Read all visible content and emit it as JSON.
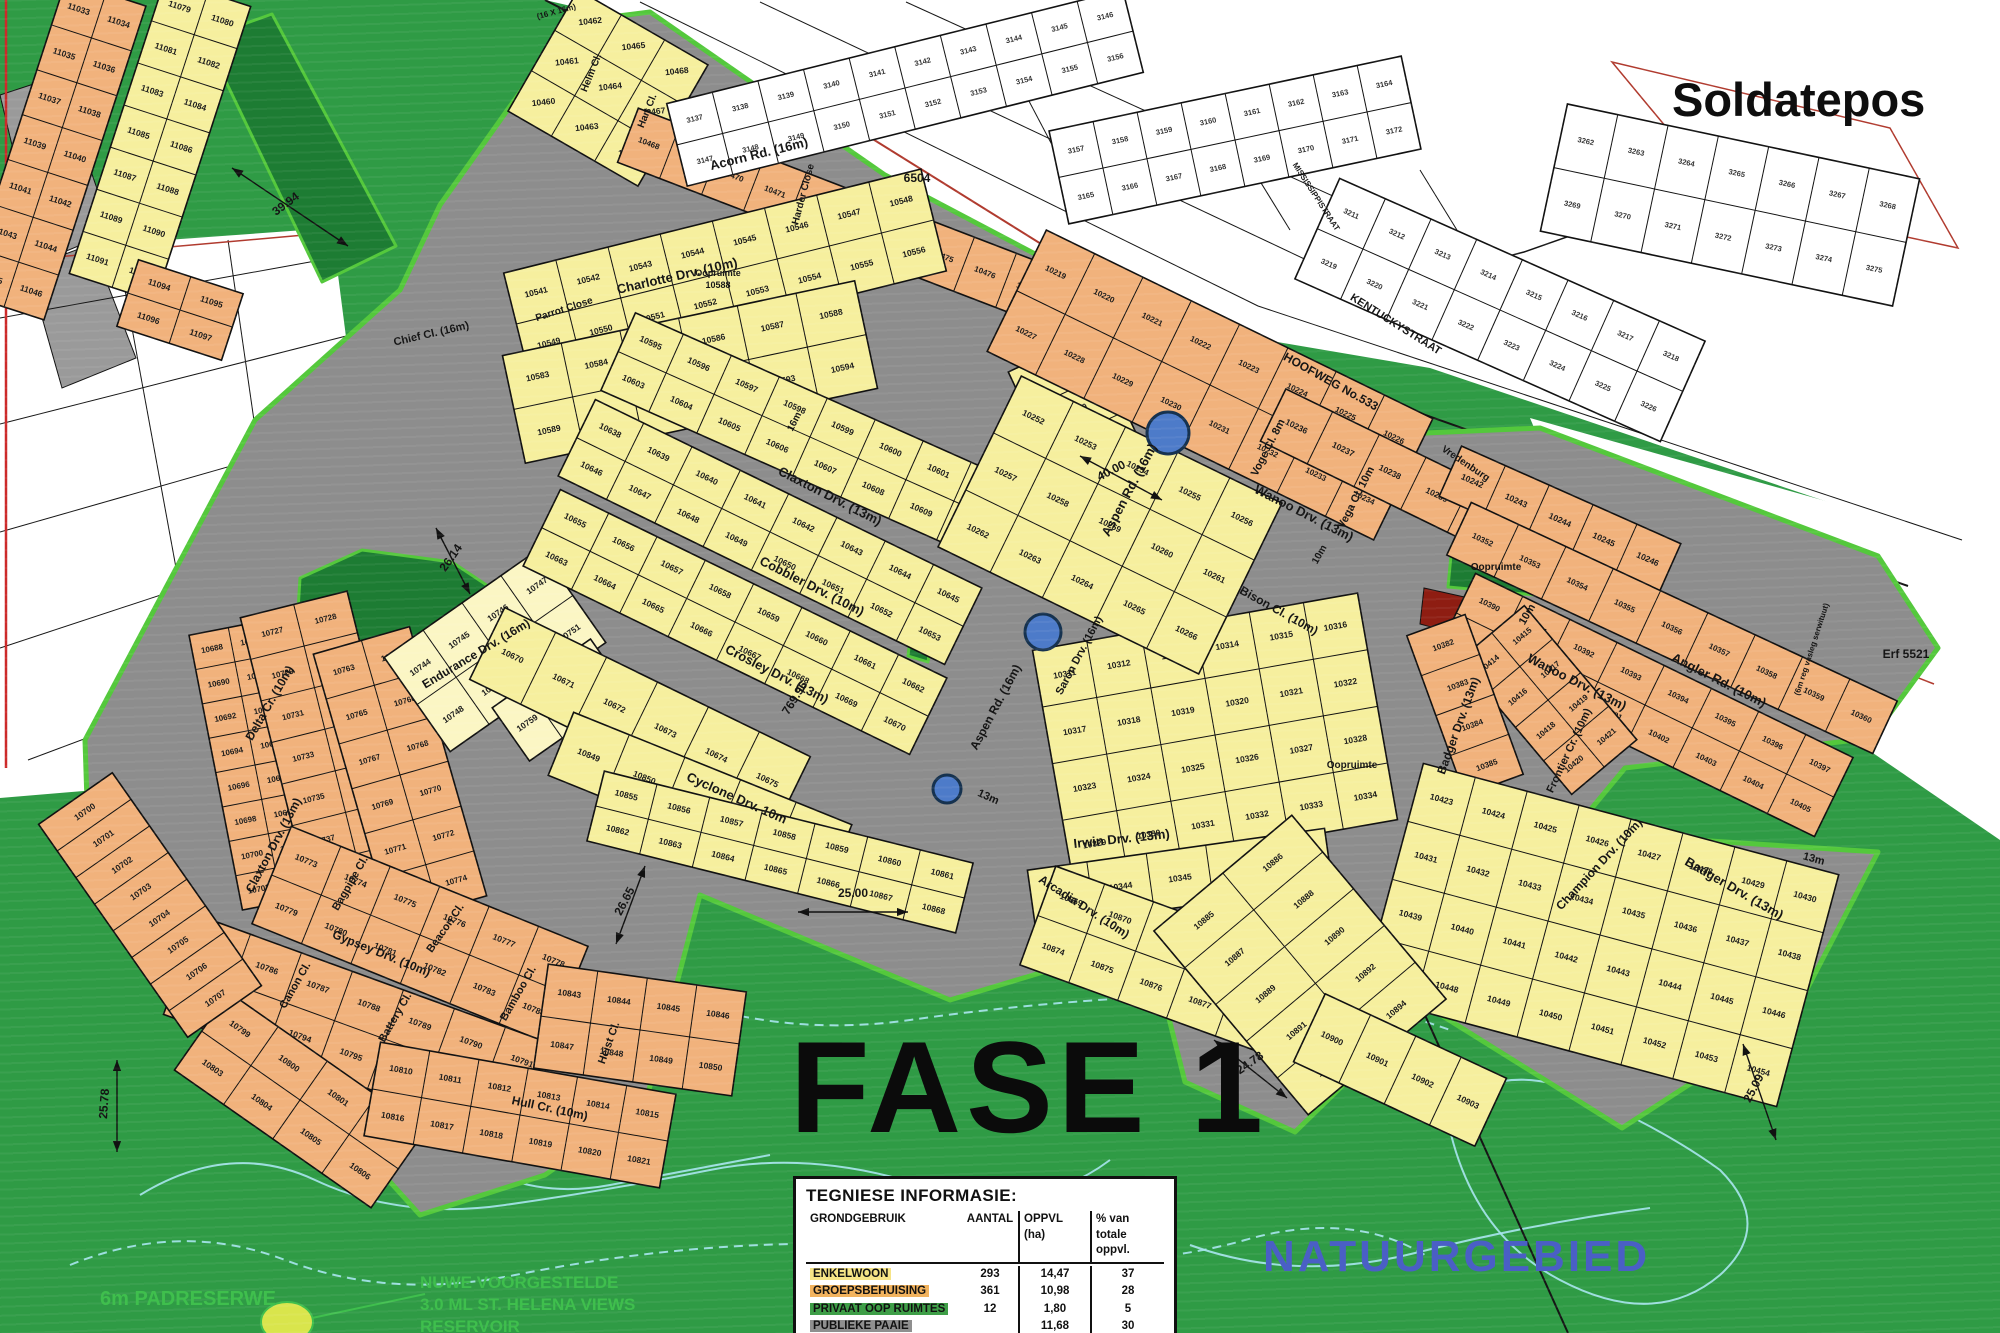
{
  "big": {
    "soldatepos": "Soldatepos",
    "fase": "FASE 1",
    "natuurgebied": "NATUURGEBIED",
    "padreserwe": "6m PADRESERWE",
    "res1": "NUWE VOORGESTELDE",
    "res2": "3.0 ML ST. HELENA VIEWS",
    "res3": "RESERVOIR"
  },
  "table": {
    "title": "TEGNIESE INFORMASIE:",
    "headers": [
      "GRONDGEBRUIK",
      "AANTAL",
      "OPPVL (ha)",
      "% van totale oppvl."
    ],
    "rows": [
      {
        "label": "ENKELWOON",
        "aantal": "293",
        "oppvl": "14,47",
        "pct": "37",
        "hl": "#F6E487"
      },
      {
        "label": "GROEPSBEHUISING",
        "aantal": "361",
        "oppvl": "10,98",
        "pct": "28",
        "hl": "#F2B35E"
      },
      {
        "label": "PRIVAAT OOP RUIMTES",
        "aantal": "12",
        "oppvl": "1,80",
        "pct": "5",
        "hl": "#3E9E47"
      },
      {
        "label": "PUBLIEKE PAAIE",
        "aantal": "",
        "oppvl": "11,68",
        "pct": "30",
        "hl": "#8F8F8F"
      }
    ],
    "total": {
      "label": "TOTAAL",
      "aantal": "666",
      "oppvl": "38,16",
      "pct": "100"
    }
  },
  "map": {
    "colors": {
      "bg": "#2F9B45",
      "road": "#8D8D8D",
      "boundary": "#54C83C",
      "openspace": "#1D7C33",
      "redpatch": "#8E1D12",
      "contour": "#A8E6EE",
      "y": "#F6EF9E",
      "o": "#F1B27C",
      "p": "#FBF6C4",
      "w": "#FFFFFF",
      "g": "#9A9A9A",
      "roundabout": "#4D7BC9",
      "natuur_text": "#4A5FC5",
      "green_text": "#3FBF4D"
    },
    "white_areas": [
      "545,0 2000,0 2000,560 1430,368 1160,322 878,172 640,22",
      "0,252 332,228 398,742 332,770 0,798",
      "1530,418 2000,550 2000,840 1588,558"
    ],
    "gray_areas": [
      "0,95 58,76 112,232 40,262",
      "28,268 92,244 136,358 62,388"
    ],
    "bases": [
      "85,740 255,420 400,290 440,205 570,22 650,12 885,175 1170,325 1140,400 1170,435 1130,705 1350,850 1310,1025 1100,955 950,1000 700,895 645,1105 545,1175 420,1215 230,1005 88,832",
      "1135,395 1310,438 1540,428 1878,556 1938,648 1872,738 1625,768 1572,832 1878,852 1792,1018 1622,1128 1425,1005 1295,1132 1185,1082 1148,935 1128,705 1168,435"
    ],
    "patches": [
      "205,38 272,14 396,246 322,282",
      "300,578 362,550 452,562 512,602 502,658 430,692 342,686 296,642",
      "690,262 748,252 762,302 702,316",
      "1452,545 1542,558 1546,596 1448,587",
      "915,598 936,604 928,662 908,656",
      "872,425 890,430 882,492 864,486"
    ],
    "red_patch": "1424,588 1478,600 1472,638 1420,624",
    "blocks": [
      [
        55,
        150,
        84,
        330,
        18,
        "o",
        11033,
        7,
        2,
        8.5
      ],
      [
        160,
        140,
        90,
        310,
        18,
        "y",
        11079,
        7,
        2,
        8.5
      ],
      [
        180,
        310,
        110,
        70,
        18,
        "o",
        11094,
        2,
        2,
        8.5
      ],
      [
        255,
        765,
        80,
        280,
        -11,
        "o",
        10688,
        8,
        2,
        8
      ],
      [
        330,
        750,
        110,
        300,
        -14,
        "o",
        10727,
        7,
        2,
        8
      ],
      [
        400,
        775,
        100,
        280,
        -16,
        "o",
        10763,
        6,
        2,
        8
      ],
      [
        495,
        650,
        190,
        115,
        -35,
        "p",
        10744,
        2,
        4,
        8.5
      ],
      [
        560,
        700,
        120,
        65,
        -35,
        "p",
        10759,
        1,
        3,
        8.5
      ],
      [
        420,
        935,
        320,
        105,
        22,
        "o",
        10773,
        2,
        6,
        8.5
      ],
      [
        360,
        1030,
        380,
        105,
        20,
        "o",
        10785,
        2,
        7,
        8.5
      ],
      [
        300,
        1100,
        240,
        95,
        35,
        "o",
        10799,
        2,
        4,
        8.5
      ],
      [
        520,
        1115,
        300,
        95,
        10,
        "o",
        10810,
        2,
        6,
        8.5
      ],
      [
        640,
        1030,
        200,
        105,
        8,
        "o",
        10843,
        2,
        4,
        8.5
      ],
      [
        150,
        905,
        90,
        260,
        -35,
        "o",
        10700,
        8,
        1,
        8.5
      ],
      [
        608,
        88,
        140,
        150,
        -60,
        "y",
        10460,
        3,
        3,
        8.5
      ],
      [
        880,
        232,
        540,
        58,
        21,
        "o",
        10468,
        1,
        12,
        8
      ],
      [
        725,
        272,
        430,
        105,
        -14,
        "y",
        10541,
        2,
        8,
        8.5
      ],
      [
        690,
        372,
        360,
        110,
        -12,
        "y",
        10583,
        2,
        6,
        8.5
      ],
      [
        810,
        437,
        420,
        85,
        24,
        "y",
        10595,
        2,
        8,
        8.5
      ],
      [
        770,
        532,
        430,
        85,
        26,
        "y",
        10638,
        2,
        8,
        8.5
      ],
      [
        735,
        622,
        430,
        85,
        26,
        "y",
        10655,
        2,
        8,
        8.5
      ],
      [
        640,
        718,
        340,
        80,
        26,
        "y",
        10670,
        1,
        6,
        8.5
      ],
      [
        700,
        800,
        300,
        68,
        22,
        "y",
        10849,
        1,
        5,
        8.5
      ],
      [
        780,
        852,
        380,
        72,
        14,
        "y",
        10855,
        2,
        7,
        8.5
      ],
      [
        1085,
        430,
        90,
        170,
        -25,
        "y",
        10529,
        4,
        1,
        8.5
      ],
      [
        1215,
        735,
        330,
        230,
        -10,
        "y",
        10311,
        4,
        6,
        8.5
      ],
      [
        1180,
        878,
        300,
        58,
        -8,
        "y",
        10343,
        1,
        5,
        8.5
      ],
      [
        1160,
        960,
        260,
        105,
        20,
        "y",
        10869,
        2,
        5,
        8.5
      ],
      [
        1210,
        385,
        430,
        135,
        26,
        "o",
        10219,
        2,
        8,
        8
      ],
      [
        1390,
        472,
        260,
        58,
        26,
        "o",
        10236,
        1,
        5,
        8.5
      ],
      [
        1560,
        520,
        240,
        55,
        24,
        "o",
        10242,
        1,
        5,
        8.5
      ],
      [
        1110,
        525,
        290,
        190,
        26,
        "y",
        10252,
        3,
        5,
        8.5
      ],
      [
        1672,
        628,
        470,
        58,
        25,
        "o",
        10352,
        1,
        9,
        8
      ],
      [
        1645,
        705,
        420,
        88,
        26,
        "o",
        10390,
        2,
        8,
        8
      ],
      [
        1548,
        700,
        85,
        175,
        -40,
        "o",
        10414,
        4,
        2,
        8
      ],
      [
        1465,
        705,
        62,
        170,
        -20,
        "o",
        10382,
        4,
        1,
        8
      ],
      [
        1600,
        935,
        430,
        240,
        15,
        "y",
        10423,
        4,
        8,
        8.5
      ],
      [
        1300,
        965,
        180,
        240,
        -40,
        "y",
        10885,
        5,
        2,
        8.5
      ],
      [
        1400,
        1070,
        200,
        75,
        25,
        "y",
        10900,
        1,
        4,
        8.5
      ],
      [
        905,
        88,
        470,
        85,
        -14,
        "w",
        3137,
        2,
        10,
        7.5
      ],
      [
        1235,
        140,
        360,
        95,
        -12,
        "w",
        3157,
        2,
        8,
        7.5
      ],
      [
        1500,
        310,
        400,
        110,
        24,
        "w",
        3211,
        2,
        8,
        7.5
      ],
      [
        1730,
        205,
        360,
        130,
        12,
        "w",
        3262,
        2,
        7,
        7.5
      ]
    ],
    "roundabouts": [
      [
        1168,
        433,
        21
      ],
      [
        1043,
        632,
        18
      ],
      [
        947,
        789,
        14
      ]
    ],
    "streets": [
      [
        "Acorn Rd. (16m)",
        760,
        158,
        -14,
        13
      ],
      [
        "Harder Close",
        806,
        195,
        -75,
        10
      ],
      [
        "Helm Cl.",
        594,
        74,
        -68,
        10
      ],
      [
        "Hart Cl.",
        650,
        112,
        -68,
        10
      ],
      [
        "Charlotte Drv. (10m)",
        678,
        280,
        -13,
        13
      ],
      [
        "Parrot Close",
        565,
        312,
        -18,
        10
      ],
      [
        "Chief Cl. (16m)",
        432,
        337,
        -13,
        11
      ],
      [
        "Claxton Drv. (13m)",
        828,
        500,
        27,
        13
      ],
      [
        "Cobbler Drv. (10m)",
        810,
        590,
        27,
        13
      ],
      [
        "Crosley Drv. (13m)",
        775,
        678,
        27,
        13
      ],
      [
        "Cyclone Drv. 10m",
        735,
        802,
        24,
        13
      ],
      [
        "Irwin Drv. (13m)",
        1122,
        843,
        -6,
        13
      ],
      [
        "Arcadia Drv. (10m)",
        1082,
        910,
        33,
        12
      ],
      [
        "Aspen Rd. (16m)",
        1133,
        492,
        -62,
        13
      ],
      [
        "Aspen Rd. (16m)",
        999,
        709,
        -62,
        12
      ],
      [
        "Saron Drv. (16m)",
        1082,
        657,
        -62,
        11
      ],
      [
        "Wanoo Drv. (13m)",
        1302,
        517,
        27,
        13
      ],
      [
        "Voge Cl. 8m",
        1271,
        449,
        -63,
        11
      ],
      [
        "Vega Cl. 10m",
        1359,
        499,
        -63,
        11
      ],
      [
        "Bison Cl. (10m)",
        1277,
        614,
        29,
        12
      ],
      [
        "Endurance Drv. (16m)",
        478,
        657,
        -31,
        12
      ],
      [
        "Delta Cr. (10m)",
        273,
        705,
        -60,
        12
      ],
      [
        "Claxton Drv. (13m)",
        277,
        847,
        -62,
        12
      ],
      [
        "Gypsey Drv. (10m)",
        380,
        957,
        22,
        12
      ],
      [
        "Bagpipe Cl.",
        353,
        885,
        -60,
        11
      ],
      [
        "Beacon Cl.",
        448,
        930,
        -55,
        11
      ],
      [
        "Canon Cl.",
        298,
        987,
        -60,
        11
      ],
      [
        "Battery Cl.",
        398,
        1019,
        -60,
        11
      ],
      [
        "Bamboo Cl.",
        521,
        995,
        -60,
        11
      ],
      [
        "Heist Cl.",
        612,
        1044,
        -70,
        11
      ],
      [
        "Hull Cr. (10m)",
        549,
        1112,
        12,
        12
      ],
      [
        "Wanoo Drv. (13m)",
        1575,
        686,
        27,
        13
      ],
      [
        "Angler Rd. (10m)",
        1717,
        684,
        27,
        13
      ],
      [
        "Badger Drv. (13m)",
        1462,
        727,
        -70,
        12
      ],
      [
        "Badger Drv. (13m)",
        1732,
        892,
        30,
        13
      ],
      [
        "Frontier Cr. (10m)",
        1572,
        752,
        -65,
        11
      ],
      [
        "Champion Drv. (10m)",
        1602,
        867,
        -47,
        12
      ],
      [
        "HOOFWEG No.533",
        1329,
        385,
        29,
        12
      ],
      [
        "KENTUCKYSTRAAT",
        1394,
        327,
        32,
        11
      ],
      [
        "MISSISSIPPISTRAAT",
        1314,
        198,
        57,
        8
      ],
      [
        "Vredenburg",
        1464,
        466,
        34,
        10
      ]
    ],
    "labels": [
      [
        "Oopruimte",
        718,
        276,
        0,
        9
      ],
      [
        "10588",
        718,
        288,
        0,
        9
      ],
      [
        "Oopruimte",
        1496,
        570,
        0,
        10
      ],
      [
        "Oopruimte",
        1352,
        768,
        0,
        10
      ],
      [
        "Erf 5521",
        1906,
        658,
        0,
        12
      ],
      [
        "6504",
        917,
        182,
        0,
        12
      ],
      [
        "(16 X 16m)",
        557,
        14,
        -15,
        8
      ],
      [
        "(6m reg vasleg serwituut)",
        1814,
        650,
        -72,
        8
      ],
      [
        "13m",
        987,
        800,
        24,
        11
      ],
      [
        "13m",
        1813,
        862,
        15,
        11
      ],
      [
        "10m",
        1530,
        616,
        -60,
        11
      ],
      [
        "16m",
        797,
        423,
        -63,
        10
      ],
      [
        "10m",
        1322,
        556,
        -60,
        10
      ]
    ],
    "dims": [
      [
        "39.94",
        288,
        207,
        -37,
        [
          232,
          168,
          348,
          246
        ]
      ],
      [
        "26.14",
        454,
        560,
        -55,
        [
          436,
          528,
          470,
          594
        ]
      ],
      [
        "25.00",
        853,
        897,
        0,
        [
          798,
          912,
          908,
          912
        ]
      ],
      [
        "769.96",
        798,
        700,
        -58,
        null
      ],
      [
        "26.65",
        628,
        903,
        -62,
        [
          645,
          866,
          616,
          944
        ]
      ],
      [
        "25.78",
        108,
        1104,
        -86,
        [
          117,
          1060,
          117,
          1152
        ]
      ],
      [
        "24.78",
        1252,
        1066,
        -35,
        [
          1214,
          1040,
          1287,
          1098
        ]
      ],
      [
        "25.09",
        1757,
        1090,
        -62,
        [
          1743,
          1044,
          1776,
          1140
        ]
      ],
      [
        "40.00",
        1113,
        474,
        -27,
        [
          1080,
          456,
          1162,
          500
        ]
      ]
    ],
    "black_lines": [
      [
        "M1165,328 L1335,815 L1568,1333",
        2
      ],
      [
        "M545,0 L1180,328 L1908,586",
        2
      ],
      [
        "M640,2 L1258,306 L1962,540",
        1
      ],
      [
        "M760,2 L1332,272",
        1
      ],
      [
        "M906,2 L1434,242",
        1
      ],
      [
        "M1352,297 L1524,252 L1752,172",
        1.5
      ],
      [
        "M930,1182 L1062,1333",
        1.2
      ],
      [
        "M0,318 L332,258",
        1
      ],
      [
        "M0,424 L362,332",
        1
      ],
      [
        "M0,532 L378,424",
        1
      ],
      [
        "M0,648 L388,520",
        1
      ],
      [
        "M28,760 L396,622",
        1
      ],
      [
        "M118,252 L208,742",
        1
      ],
      [
        "M228,240 L298,726",
        1
      ],
      [
        "M1000,46 L1060,160",
        1
      ],
      [
        "M1210,100 L1290,230",
        1
      ],
      [
        "M1420,170 L1500,300",
        1
      ]
    ],
    "red_lines": [
      [
        "M6,0 L6,768",
        "#CC2A2A",
        2.5
      ],
      [
        "M0,262 L338,232",
        "#B03A2E",
        1.5
      ],
      [
        "M855,128 L1192,338",
        "#B03A2E",
        2
      ],
      [
        "M1612,62 L1890,128 L1958,248 L1725,198 Z",
        "#B03A2E",
        1.5
      ],
      [
        "M1800,632 L1934,684",
        "#B03A2E",
        1.5
      ]
    ],
    "contours": [
      [
        "M140,1195 q90,-55 175,-15 t190,25 t205,-35 t210,15 t190,-25",
        0
      ],
      [
        "M70,1265 q110,-45 215,-5 t230,15 t245,-30 t250,10 t235,-15 t180,15",
        1
      ],
      [
        "M845,1245 q35,-75 135,-65 q125,12 105,85 q-18,62 -125,50 q-105,-10 -115,-70 z",
        0
      ],
      [
        "M1445,1105 q65,-45 140,-10 q80,35 135,75 q55,55 0,105 q-65,55 -160,5 q-95,-50 -115,-175 z",
        0
      ],
      [
        "M330,585 q35,-28 70,-8 t80,12",
        0
      ],
      [
        "M345,640 q45,22 90,6 t85,-10",
        0
      ],
      [
        "M640,985 q130,55 270,35 t285,-25 t255,35",
        1
      ],
      [
        "M1190,1245 q105,38 225,8 t235,-45",
        0
      ],
      [
        "M470,1160 q60,40 140,25 t160,-30",
        0
      ]
    ],
    "leader": {
      "line": [
        312,
        1318,
        425,
        1294
      ],
      "ellipse": [
        287,
        1322,
        26,
        20
      ]
    }
  }
}
